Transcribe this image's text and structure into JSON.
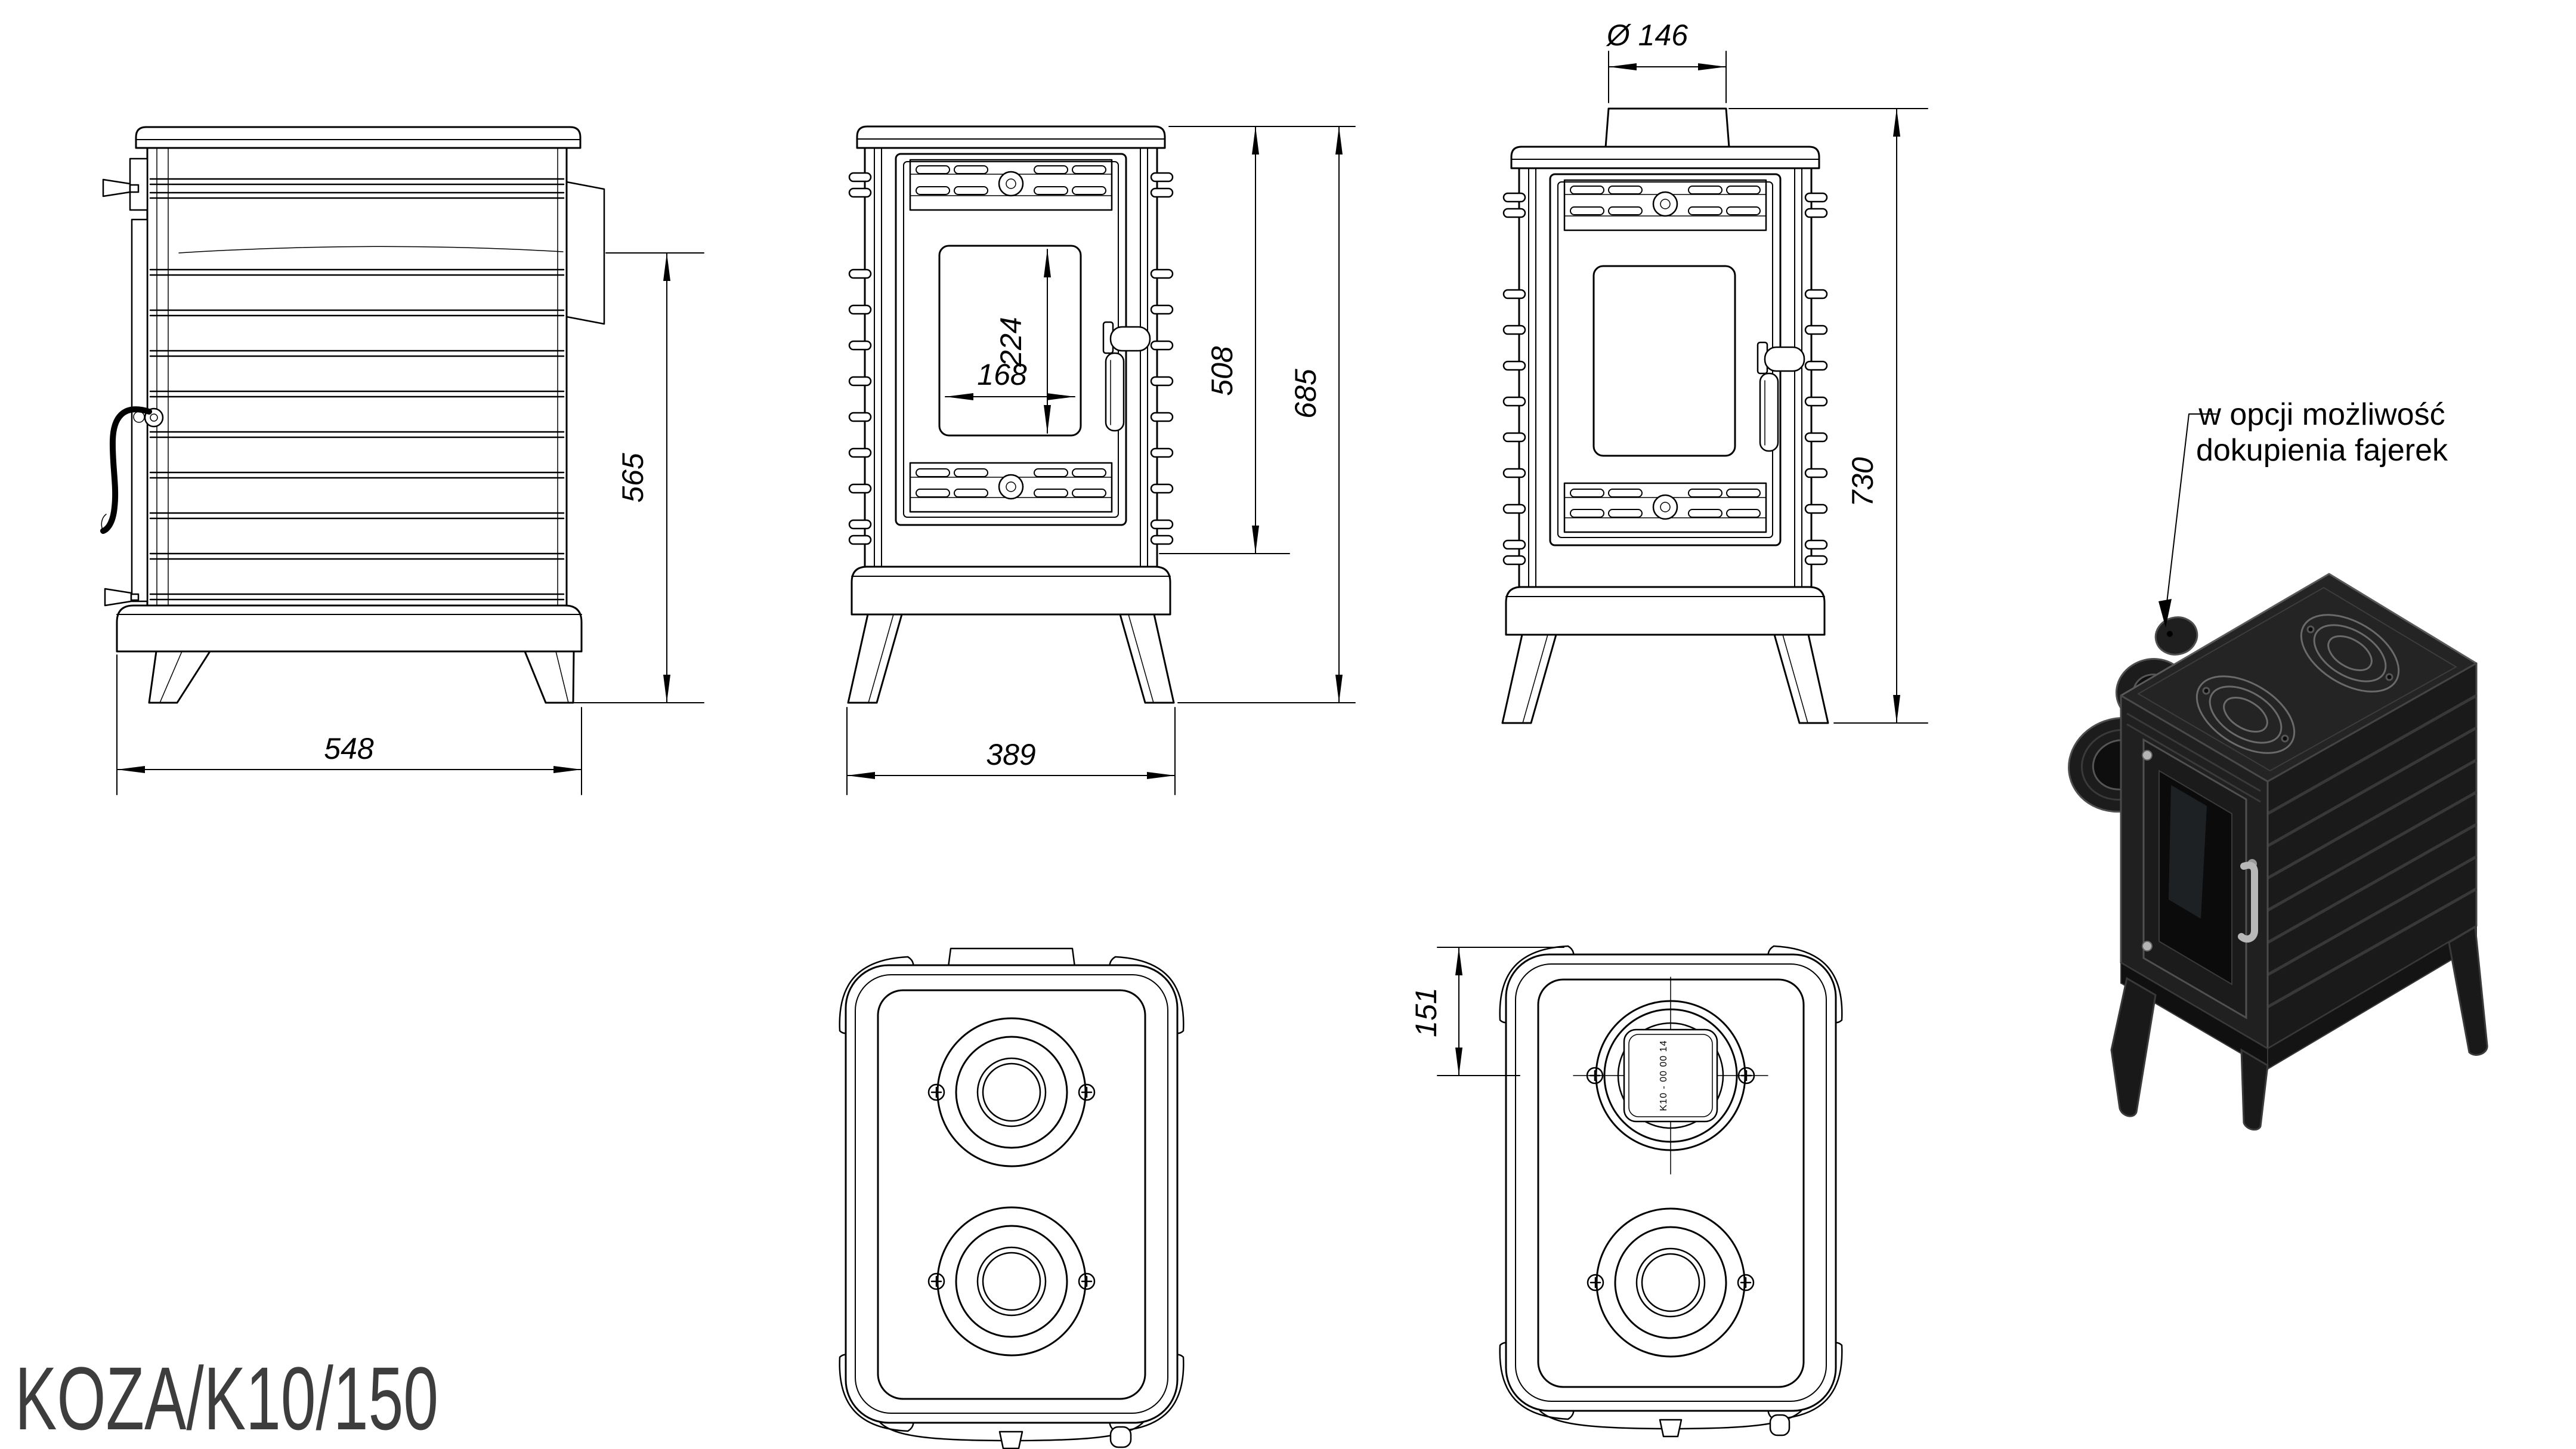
{
  "sheet": {
    "paper_color": "#ffffff",
    "ink_color": "#000000"
  },
  "title": {
    "text": "KOZA/K10/150",
    "color": "#3d3d3d"
  },
  "annotation": {
    "line1": "w opcji możliwość",
    "line2": "dokupienia fajerek"
  },
  "views": {
    "side": {
      "dim_depth": "548",
      "dim_height_to_outlet": "565"
    },
    "front": {
      "dim_width": "389",
      "dim_glass_width": "168",
      "dim_glass_height": "224",
      "dim_body_height": "508",
      "dim_total_height": "685"
    },
    "front_flue": {
      "dim_flue_diameter": "Ø 146",
      "dim_total_height_with_flue": "730"
    },
    "top_flue": {
      "dim_flue_center_offset": "151",
      "flue_collar_stamp": "K10 - 00 00 14"
    }
  },
  "render": {
    "body_color": "#1e1e1e",
    "metal_color": "#b5b5b5"
  }
}
